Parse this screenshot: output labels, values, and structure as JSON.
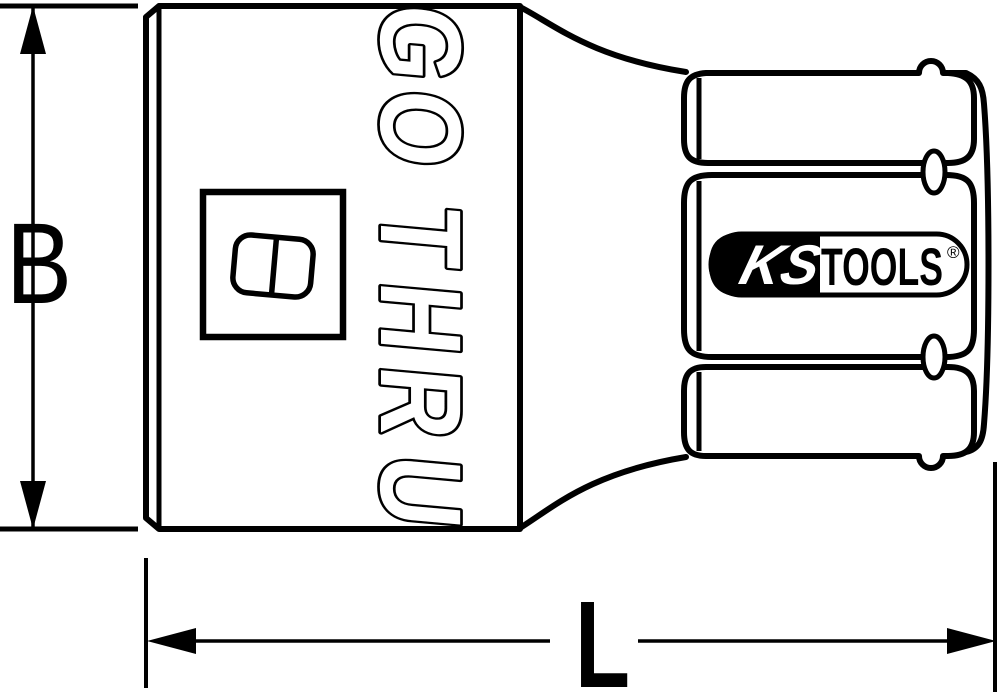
{
  "drawing": {
    "dimensions": {
      "b_label": "B",
      "l_label": "L"
    },
    "engraving": {
      "text": "GO THRU",
      "letters": [
        "G",
        "O",
        "T",
        "H",
        "R",
        "U"
      ]
    },
    "logo": {
      "brand_left": "KS",
      "brand_right": "TOOLS",
      "registered_mark": "®"
    },
    "colors": {
      "line": "#000000",
      "background": "#ffffff"
    }
  }
}
